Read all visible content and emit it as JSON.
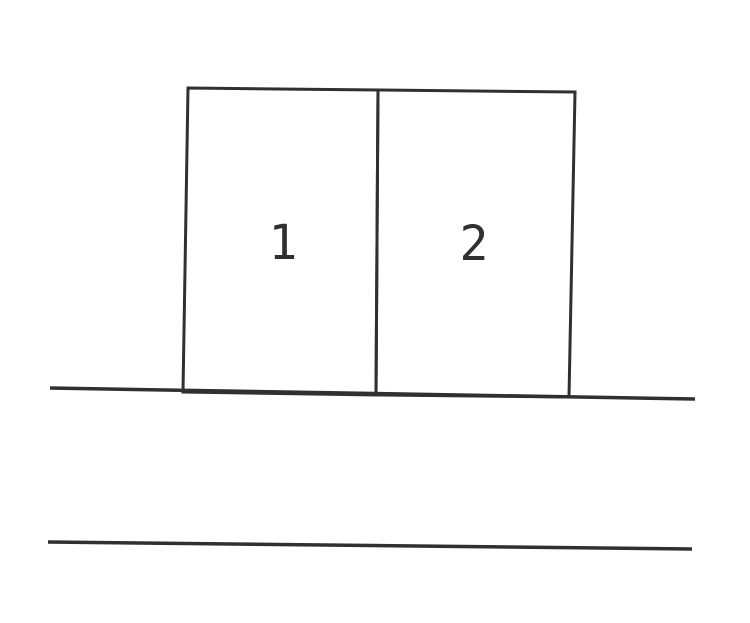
{
  "figure": {
    "blocks": [
      {
        "label": "1"
      },
      {
        "label": "2"
      }
    ],
    "colors": {
      "ink": "#303030",
      "background": "#ffffff"
    }
  }
}
